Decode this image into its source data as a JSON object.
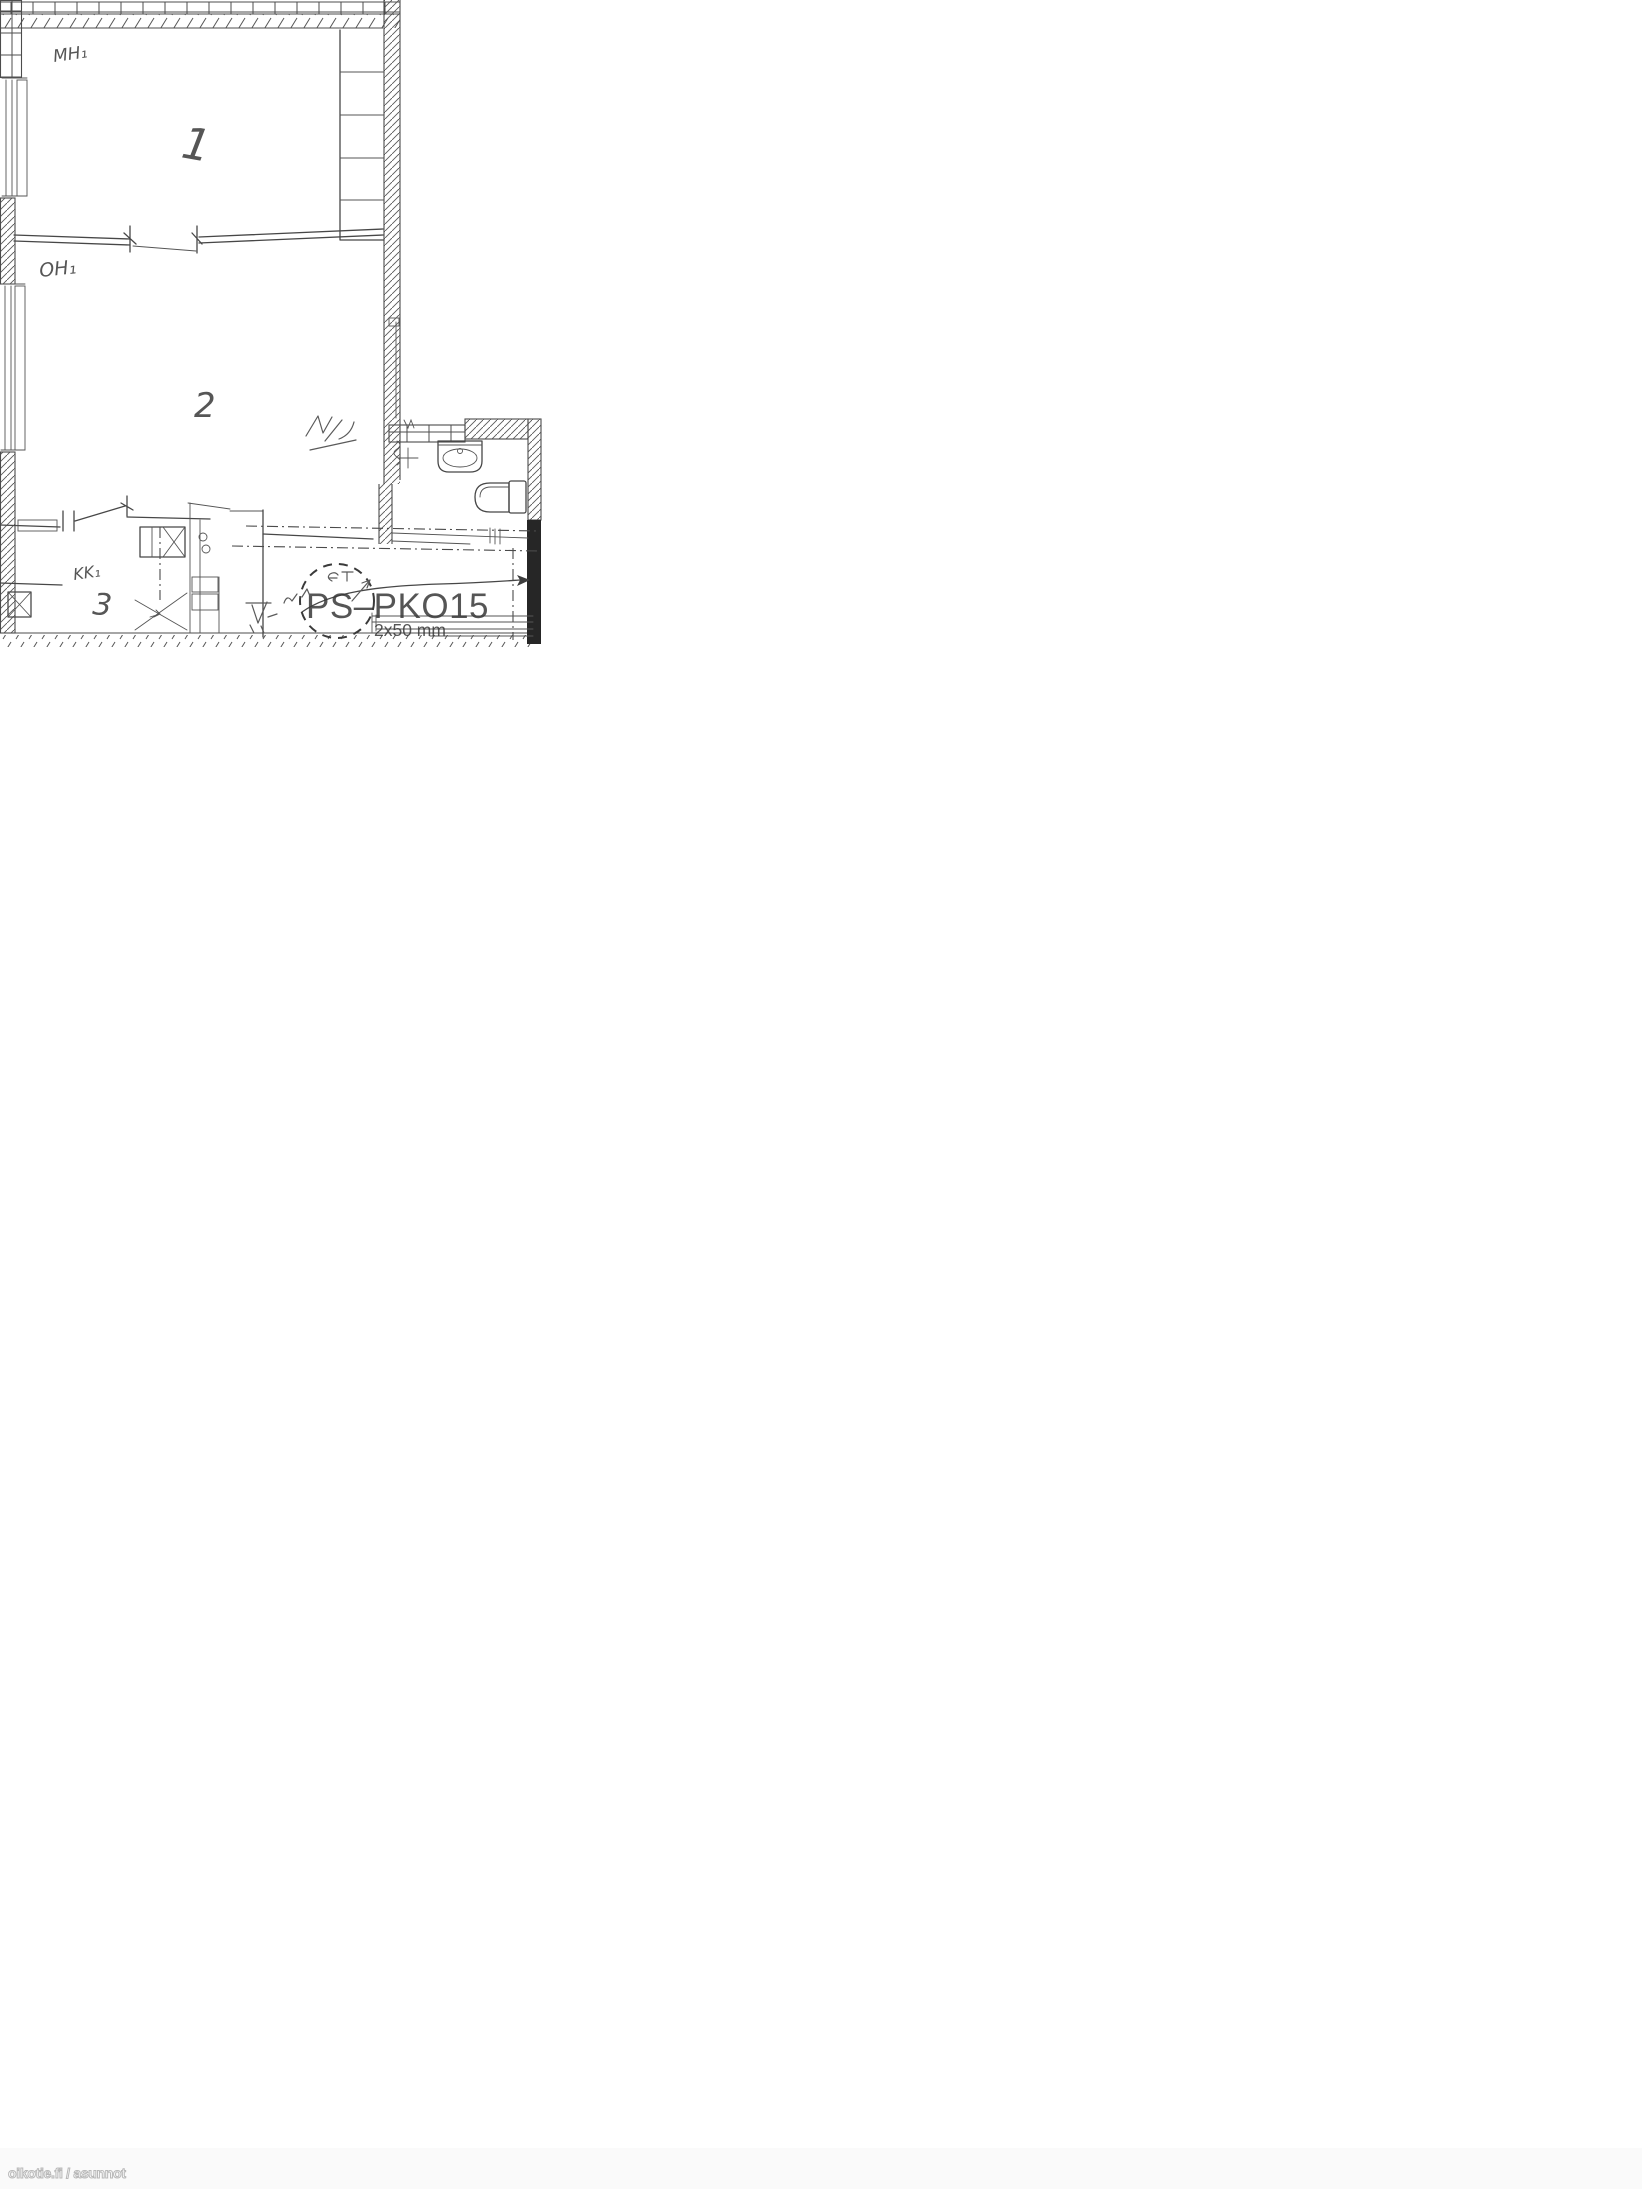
{
  "plan": {
    "room_labels": {
      "bedroom": "MH₁",
      "living": "OH₁",
      "kitchenette": "KK₁"
    },
    "room_numbers": {
      "bedroom": "1",
      "living": "2",
      "kitchenette": "3"
    },
    "stamp": {
      "code": "PS–PKO15",
      "size_note": "2x50 mm"
    }
  },
  "watermark": {
    "text": "oikotie.fi / asunnot"
  },
  "colors": {
    "ink": "#474747",
    "paper": "#ffffff",
    "watermark_outline": "#b8b8b8"
  }
}
